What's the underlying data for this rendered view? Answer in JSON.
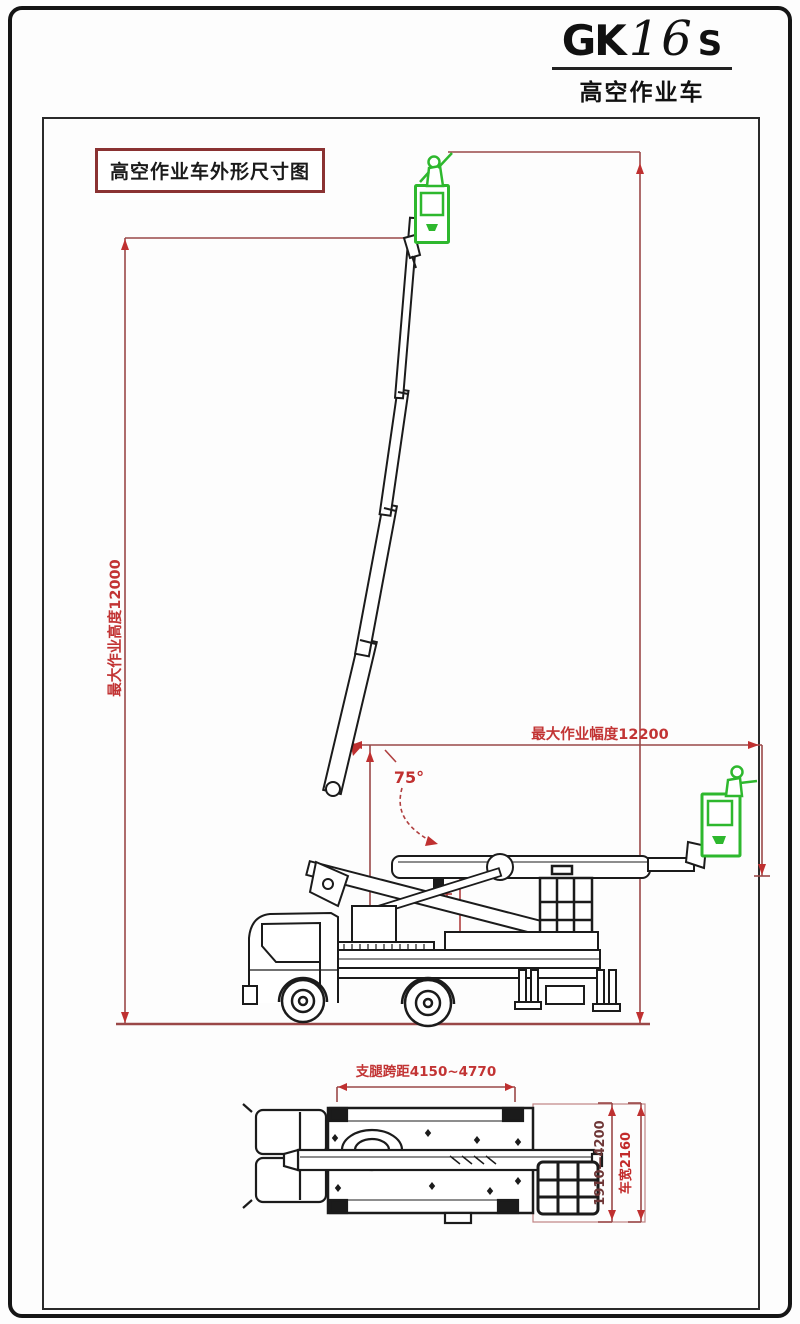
{
  "header": {
    "model_prefix": "GK",
    "model_number": "16",
    "model_suffix": "S",
    "subtitle": "高空作业车"
  },
  "drawing": {
    "label": "高空作业车外形尺寸图",
    "dimensions": {
      "max_working_height": "最大作业高度12000",
      "max_working_radius": "最大作业幅度12200",
      "boom_angle": "75°",
      "outrigger_span_longitudinal": "支腿跨距4150~4770",
      "outrigger_span_lateral": "1910—4200",
      "vehicle_width": "车宽2160"
    },
    "colors": {
      "dimension_line": "#9a4848",
      "dimension_text": "#c23434",
      "drawing_line": "#1b1b1b",
      "basket_green": "#2eb82e",
      "label_border": "#8a3232"
    }
  }
}
